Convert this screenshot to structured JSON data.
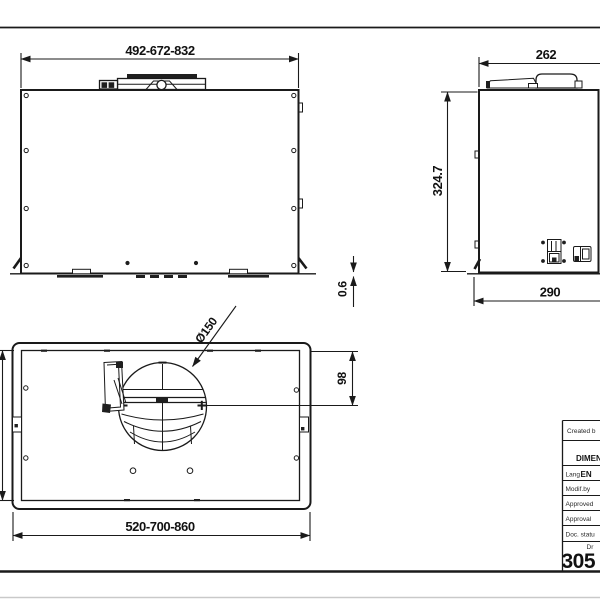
{
  "drawing": {
    "front_view": {
      "width_dim": "492-672-832",
      "panel_gap_dim": "0.6"
    },
    "side_view": {
      "top_width_dim": "262",
      "height_dim": "324.7",
      "depth_dim": "290"
    },
    "top_view": {
      "duct_diameter": "Ø150",
      "duct_offset_dim": "98",
      "width_dim": "520-700-860"
    },
    "title_block": {
      "created_by_label": "Created b",
      "doc_title": "DIMEN",
      "lang_label": "Lang",
      "lang_value": "EN",
      "modified_by_label": "Modif.by",
      "approved_label": "Approved",
      "approval_label": "Approval",
      "doc_status_label": "Doc. statu",
      "drawing_label": "Dr",
      "drawing_number": "305"
    }
  }
}
